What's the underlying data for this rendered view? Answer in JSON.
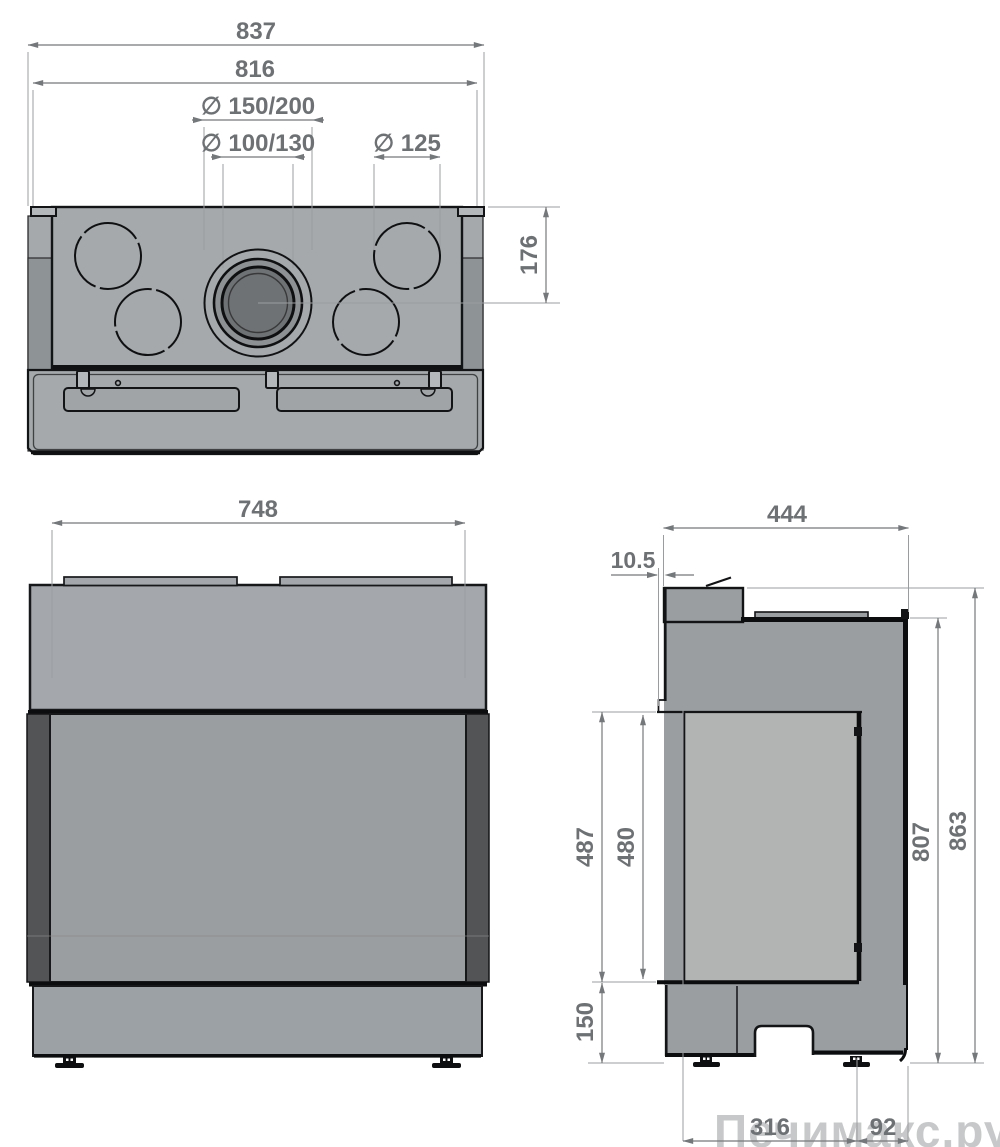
{
  "drawing": {
    "type": "fireplace-insert-three-view-technical-drawing",
    "views": {
      "top": {
        "dims": {
          "overall_width": "837",
          "inner_width": "816",
          "flue_diameter": "∅ 150/200",
          "intake_diameter": "∅ 100/130",
          "knockout_diameter": "∅ 125",
          "rear_to_flue": "176"
        }
      },
      "front": {
        "dims": {
          "glass_width": "748"
        }
      },
      "side": {
        "dims": {
          "depth": "444",
          "front_offset": "10.5",
          "opening_height": "487",
          "glass_height": "480",
          "body_height": "807",
          "total_height": "863",
          "base_height": "150",
          "foot_spacing": "316",
          "rear_span": "92"
        }
      }
    },
    "colors": {
      "background": "#ffffff",
      "body_gray": "#a5a9ac",
      "strip_gray": "#8e9396",
      "side_body_gray": "#9a9ea1",
      "side_glass_gray": "#b2b4b4",
      "front_window_gray": "#9b9ea0",
      "dark_trim": "#535456",
      "base_gray": "#9ca1a5",
      "flue_ring": "#8e9193",
      "flue_pipe": "#6f7274",
      "outline": "#131416",
      "dimension": "#75787b",
      "watermark": "#c7c8c9"
    },
    "watermark": "Печимакс.ру"
  }
}
